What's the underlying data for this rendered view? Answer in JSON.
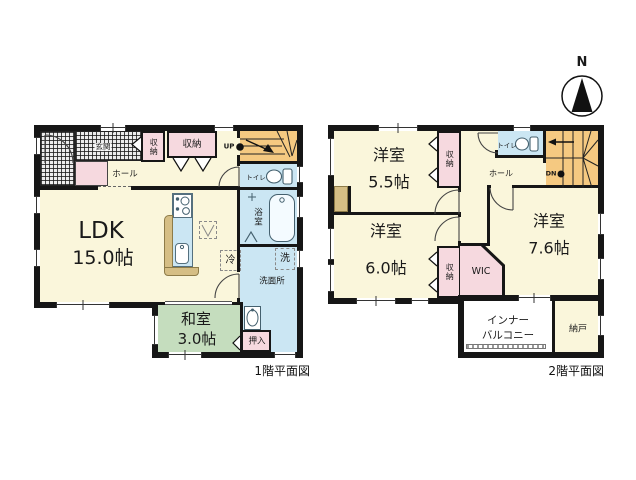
{
  "palette": {
    "cream": "#FAF6DB",
    "pink": "#F6D9DF",
    "blue": "#CBE6F3",
    "green": "#C5DDBE",
    "orange": "#F5C981",
    "tan": "#D5BE85",
    "wall": "#161616"
  },
  "compass": {
    "label": "N"
  },
  "captions": {
    "floor1": "1階平面図",
    "floor2": "2階平面図"
  },
  "floor1": {
    "genkan": "玄関",
    "hall": "ホール",
    "closet_a": "収納",
    "closet_b": "収納",
    "stairs": "UP",
    "toilet": "トイレ",
    "bath": "浴室",
    "washroom": "洗面所",
    "washer": "洗",
    "fridge": "冷",
    "ldk_label": "LDK",
    "ldk_size": "15.0帖",
    "washitsu_label": "和室",
    "washitsu_size": "3.0帖",
    "oshiire": "押入"
  },
  "floor2": {
    "room55_label": "洋室",
    "room55_size": "5.5帖",
    "room60_label": "洋室",
    "room60_size": "6.0帖",
    "room76_label": "洋室",
    "room76_size": "7.6帖",
    "closet_a": "収納",
    "closet_b": "収納",
    "toilet": "トイレ",
    "hall": "ホール",
    "stairs": "DN",
    "wic": "WIC",
    "balcony_line1": "インナー",
    "balcony_line2": "バルコニー",
    "nando": "納戸"
  }
}
